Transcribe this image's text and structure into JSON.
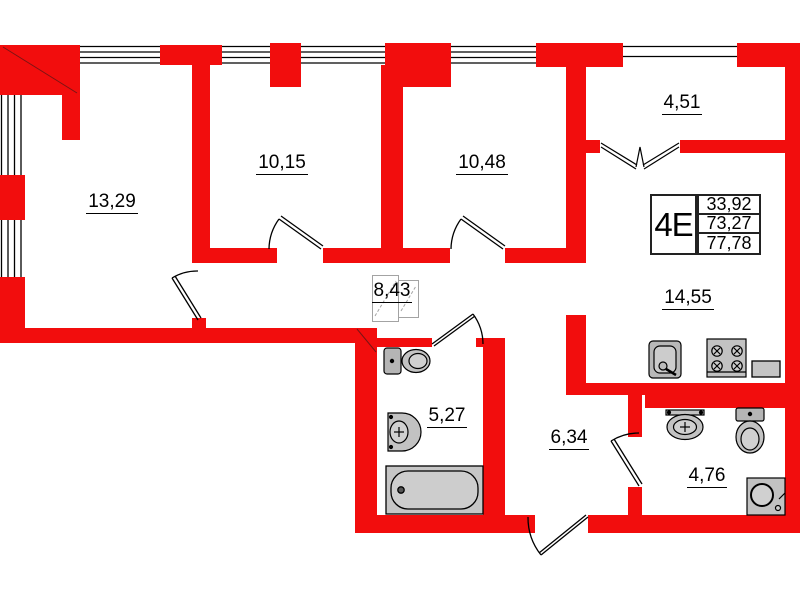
{
  "colors": {
    "wall": "#f20d0d",
    "line": "#000000",
    "fixture": "#c6c6c6"
  },
  "rooms": [
    {
      "area": "13,29"
    },
    {
      "area": "10,15"
    },
    {
      "area": "10,48"
    },
    {
      "area": "4,51"
    },
    {
      "area": "8,43"
    },
    {
      "area": "14,55"
    },
    {
      "area": "5,27"
    },
    {
      "area": "6,34"
    },
    {
      "area": "4,76"
    }
  ],
  "info_table": {
    "type": "4E",
    "values": [
      "33,92",
      "73,27",
      "77,78"
    ]
  }
}
